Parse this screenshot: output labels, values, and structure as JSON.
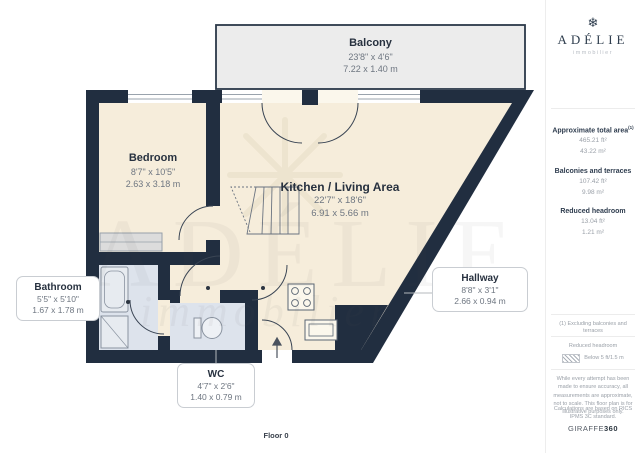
{
  "floorplan": {
    "floor_label": "Floor 0",
    "watermark": {
      "line1": "ADÉLIE",
      "line2": "immobilier"
    },
    "rooms": {
      "balcony": {
        "name": "Balcony",
        "dims_ft": "23'8\" x 4'6\"",
        "dims_m": "7.22 x 1.40 m"
      },
      "bedroom": {
        "name": "Bedroom",
        "dims_ft": "8'7\" x 10'5\"",
        "dims_m": "2.63 x 3.18 m"
      },
      "kitchen": {
        "name": "Kitchen / Living Area",
        "dims_ft": "22'7\" x 18'6\"",
        "dims_m": "6.91 x 5.66 m"
      },
      "bathroom": {
        "name": "Bathroom",
        "dims_ft": "5'5\" x 5'10\"",
        "dims_m": "1.67 x 1.78 m"
      },
      "wc": {
        "name": "WC",
        "dims_ft": "4'7\" x 2'6\"",
        "dims_m": "1.40 x 0.79 m"
      },
      "hallway": {
        "name": "Hallway",
        "dims_ft": "8'8\" x 3'1\"",
        "dims_m": "2.66 x 0.94 m"
      }
    }
  },
  "sidebar": {
    "logo": {
      "icon_glyph": "❄",
      "name": "ADÉLIE",
      "subtitle": "immobilier"
    },
    "areas": [
      {
        "label": "Approximate total area",
        "note": "(1)",
        "ft": "465.21 ft²",
        "m": "43.22 m²"
      },
      {
        "label": "Balconies and terraces",
        "note": "",
        "ft": "107.42 ft²",
        "m": "9.98 m²"
      },
      {
        "label": "Reduced headroom",
        "note": "",
        "ft": "13.04 ft²",
        "m": "1.21 m²"
      }
    ],
    "footnote": "(1) Excluding balconies and terraces",
    "legend": {
      "title": "Reduced headroom",
      "item": "Below 5 ft/1.5 m"
    },
    "disclaimer1": "While every attempt has been made to ensure accuracy, all measurements are approximate, not to scale. This floor plan is for illustrative purposes only.",
    "disclaimer2": "Calculations are based on RICS IPMS 3C standard.",
    "brand": {
      "name": "GIRAFFE",
      "suffix": "360"
    }
  },
  "colors": {
    "wall": "#212e40",
    "floor": "#f6eddb",
    "wet_floor": "#dde3ec",
    "balcony_fill": "#ececec",
    "text_dark": "#27313f",
    "text_gray": "#6e7681"
  }
}
